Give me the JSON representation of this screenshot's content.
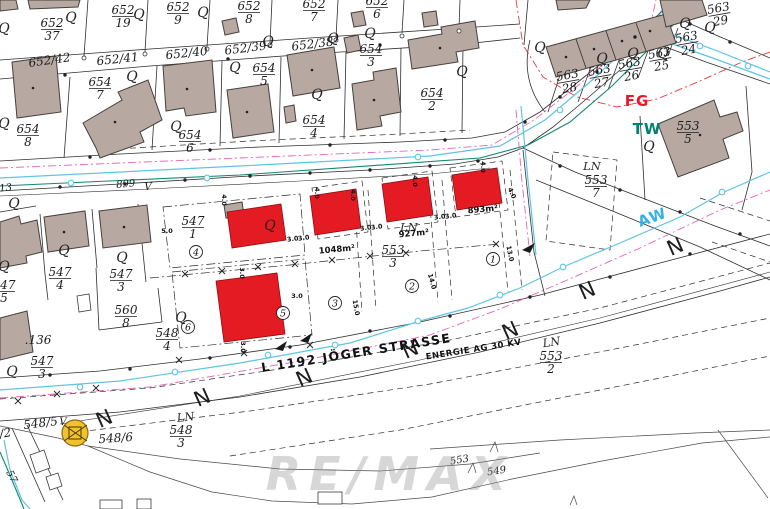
{
  "map": {
    "watermark": "RE/MAX",
    "street_name": "L 1192 JÖGER STRASSE",
    "power_line": "ENERGIE AG 30 KV"
  },
  "colors": {
    "building_existing": "#b7a9a1",
    "building_proposed": "#e41b22",
    "water_line": "#5fc4e4",
    "tw_line": "#11876f",
    "fg_line": "#e23a3a",
    "magenta_line": "#e466b4",
    "transformer_yellow": "#f2c12e"
  },
  "labels": {
    "fractions": [
      {
        "num": "652",
        "den": "37",
        "x": 52,
        "y": 27
      },
      {
        "num": "652",
        "den": "19",
        "x": 123,
        "y": 14
      },
      {
        "num": "652",
        "den": "9",
        "x": 178,
        "y": 11
      },
      {
        "num": "652",
        "den": "8",
        "x": 249,
        "y": 10
      },
      {
        "num": "652",
        "den": "7",
        "x": 314,
        "y": 8
      },
      {
        "num": "652",
        "den": "6",
        "x": 377,
        "y": 5
      },
      {
        "num": "654",
        "den": "8",
        "x": 28,
        "y": 133
      },
      {
        "num": "654",
        "den": "7",
        "x": 100,
        "y": 86
      },
      {
        "num": "654",
        "den": "6",
        "x": 190,
        "y": 139
      },
      {
        "num": "654",
        "den": "5",
        "x": 264,
        "y": 72
      },
      {
        "num": "654",
        "den": "4",
        "x": 314,
        "y": 124
      },
      {
        "num": "654",
        "den": "3",
        "x": 371,
        "y": 53
      },
      {
        "num": "654",
        "den": "2",
        "x": 432,
        "y": 97
      },
      {
        "num": "563",
        "den": "28",
        "x": 568,
        "y": 79,
        "rot": -10
      },
      {
        "num": "563",
        "den": "27",
        "x": 600,
        "y": 74,
        "rot": -10
      },
      {
        "num": "563",
        "den": "26",
        "x": 630,
        "y": 67,
        "rot": -10
      },
      {
        "num": "563",
        "den": "25",
        "x": 660,
        "y": 57,
        "rot": -10
      },
      {
        "num": "563",
        "den": "24",
        "x": 687,
        "y": 41,
        "rot": -10
      },
      {
        "num": "563",
        "den": "29",
        "x": 719,
        "y": 12,
        "rot": -10
      },
      {
        "num": "553",
        "den": "5",
        "x": 688,
        "y": 130
      },
      {
        "num": "553",
        "den": "7",
        "x": 596,
        "y": 184
      },
      {
        "num": "553",
        "den": "3",
        "x": 393,
        "y": 254
      },
      {
        "num": "553",
        "den": "2",
        "x": 551,
        "y": 360
      },
      {
        "num": "547",
        "den": "1",
        "x": 193,
        "y": 225
      },
      {
        "num": "547",
        "den": "4",
        "x": 60,
        "y": 276
      },
      {
        "num": "547",
        "den": "3",
        "x": 121,
        "y": 278
      },
      {
        "num": "547",
        "den": "5",
        "x": 4,
        "y": 289
      },
      {
        "num": "560",
        "den": "8",
        "x": 126,
        "y": 314
      },
      {
        "num": "547",
        "den": "3",
        "x": 42,
        "y": 365
      },
      {
        "num": "548",
        "den": "4",
        "x": 167,
        "y": 337
      },
      {
        "num": "548",
        "den": "3",
        "x": 181,
        "y": 434
      }
    ],
    "plain": [
      {
        "t": "652/42",
        "x": 50,
        "y": 64,
        "r": -8,
        "c": "lp"
      },
      {
        "t": "652/41",
        "x": 118,
        "y": 63,
        "r": -6,
        "c": "lp"
      },
      {
        "t": "652/40",
        "x": 187,
        "y": 57,
        "r": -6,
        "c": "lp"
      },
      {
        "t": "652/39",
        "x": 246,
        "y": 52,
        "r": -7,
        "c": "lp"
      },
      {
        "t": "652/38",
        "x": 313,
        "y": 48,
        "r": -7,
        "c": "lp"
      },
      {
        "t": "548/5",
        "x": 41,
        "y": 427,
        "r": -7,
        "c": "lp"
      },
      {
        "t": "V",
        "x": 63,
        "y": 425,
        "r": 0,
        "c": "lps"
      },
      {
        "t": "548/6",
        "x": 116,
        "y": 442,
        "r": -4,
        "c": "lp"
      },
      {
        "t": "/2",
        "x": 6,
        "y": 437,
        "r": -10,
        "c": "lp"
      },
      {
        "t": "57",
        "x": 9,
        "y": 478,
        "r": 62,
        "c": "lps"
      },
      {
        "t": ".136",
        "x": 38,
        "y": 344,
        "r": 0,
        "c": "lp"
      },
      {
        "t": "899",
        "x": 126,
        "y": 187,
        "r": -5,
        "c": "lps"
      },
      {
        "t": "V",
        "x": 148,
        "y": 190,
        "r": 0,
        "c": "lps"
      },
      {
        "t": "13",
        "x": 6,
        "y": 191,
        "r": -6,
        "c": "lps"
      },
      {
        "t": "553",
        "x": 460,
        "y": 463,
        "r": -10,
        "c": "lps"
      },
      {
        "t": "549",
        "x": 497,
        "y": 474,
        "r": -8,
        "c": "lps"
      },
      {
        "t": "LN",
        "x": 592,
        "y": 170,
        "r": 0,
        "c": "ln"
      },
      {
        "t": "LN",
        "x": 409,
        "y": 231,
        "r": 0,
        "c": "ln"
      },
      {
        "t": "LN",
        "x": 552,
        "y": 346,
        "r": -8,
        "c": "ln"
      },
      {
        "t": "LN",
        "x": 186,
        "y": 421,
        "r": -6,
        "c": "ln"
      },
      {
        "t": "1048m²",
        "x": 337,
        "y": 252,
        "r": -5,
        "c": "area"
      },
      {
        "t": "927m²",
        "x": 414,
        "y": 236,
        "r": -5,
        "c": "area"
      },
      {
        "t": "893m²",
        "x": 483,
        "y": 212,
        "r": -5,
        "c": "area"
      },
      {
        "t": "L 1192 JÖGER STRASSE",
        "x": 357,
        "y": 357,
        "r": -9,
        "c": "street"
      },
      {
        "t": "ENERGIE AG 30 KV",
        "x": 474,
        "y": 352,
        "r": -9,
        "c": "energy"
      },
      {
        "t": "FG",
        "x": 637,
        "y": 106,
        "r": 0,
        "c": "fg"
      },
      {
        "t": "TW",
        "x": 647,
        "y": 134,
        "r": 0,
        "c": "tww"
      },
      {
        "t": "AW",
        "x": 654,
        "y": 222,
        "r": -20,
        "c": "aw"
      }
    ],
    "circled": [
      {
        "n": "4",
        "x": 196,
        "y": 252
      },
      {
        "n": "5",
        "x": 283,
        "y": 313
      },
      {
        "n": "3",
        "x": 335,
        "y": 303
      },
      {
        "n": "2",
        "x": 412,
        "y": 286
      },
      {
        "n": "1",
        "x": 493,
        "y": 259
      },
      {
        "n": "6",
        "x": 188,
        "y": 327
      }
    ],
    "dims": [
      {
        "t": "5.0",
        "x": 167,
        "y": 233,
        "r": 0
      },
      {
        "t": "4.0",
        "x": 222,
        "y": 200,
        "r": 90
      },
      {
        "t": "4.0",
        "x": 315,
        "y": 193,
        "r": 90
      },
      {
        "t": "4.0",
        "x": 351,
        "y": 195,
        "r": 90
      },
      {
        "t": "4.0",
        "x": 413,
        "y": 181,
        "r": 90
      },
      {
        "t": "4.0",
        "x": 481,
        "y": 167,
        "r": 90
      },
      {
        "t": "4.0",
        "x": 510,
        "y": 194,
        "r": 65
      },
      {
        "t": "3.0",
        "x": 293,
        "y": 241,
        "r": -8
      },
      {
        "t": "3.0",
        "x": 304,
        "y": 240,
        "r": -8
      },
      {
        "t": "3.0",
        "x": 366,
        "y": 230,
        "r": -8
      },
      {
        "t": "3.0",
        "x": 377,
        "y": 229,
        "r": -8
      },
      {
        "t": "3.0",
        "x": 440,
        "y": 219,
        "r": -8
      },
      {
        "t": "3.0",
        "x": 451,
        "y": 218,
        "r": -8
      },
      {
        "t": "3.0",
        "x": 240,
        "y": 273,
        "r": 90
      },
      {
        "t": "3.0",
        "x": 241,
        "y": 347,
        "r": 90
      },
      {
        "t": "3.0",
        "x": 297,
        "y": 298,
        "r": 0
      },
      {
        "t": "14.0",
        "x": 430,
        "y": 282,
        "r": 75
      },
      {
        "t": "13.0",
        "x": 508,
        "y": 254,
        "r": 78
      },
      {
        "t": "15.0",
        "x": 354,
        "y": 308,
        "r": 80
      }
    ],
    "land_symbols": [
      [
        4,
        33
      ],
      [
        71,
        22
      ],
      [
        139,
        19
      ],
      [
        203,
        17
      ],
      [
        268,
        46
      ],
      [
        333,
        43
      ],
      [
        370,
        38
      ],
      [
        462,
        76
      ],
      [
        317,
        99
      ],
      [
        235,
        72
      ],
      [
        132,
        81
      ],
      [
        176,
        131
      ],
      [
        4,
        128
      ],
      [
        540,
        52
      ],
      [
        602,
        63
      ],
      [
        633,
        58
      ],
      [
        663,
        58
      ],
      [
        685,
        28
      ],
      [
        710,
        32
      ],
      [
        649,
        151
      ],
      [
        64,
        255
      ],
      [
        122,
        262
      ],
      [
        4,
        271
      ],
      [
        14,
        208
      ],
      [
        270,
        230
      ],
      [
        181,
        322
      ],
      [
        12,
        376
      ]
    ],
    "land_symbol_glyph": "Q",
    "slope_marks": [
      [
        107,
        425
      ],
      [
        205,
        404
      ],
      [
        307,
        384
      ],
      [
        413,
        356
      ],
      [
        513,
        337
      ],
      [
        590,
        297
      ],
      [
        678,
        253
      ]
    ],
    "slope_glyph": "N"
  }
}
